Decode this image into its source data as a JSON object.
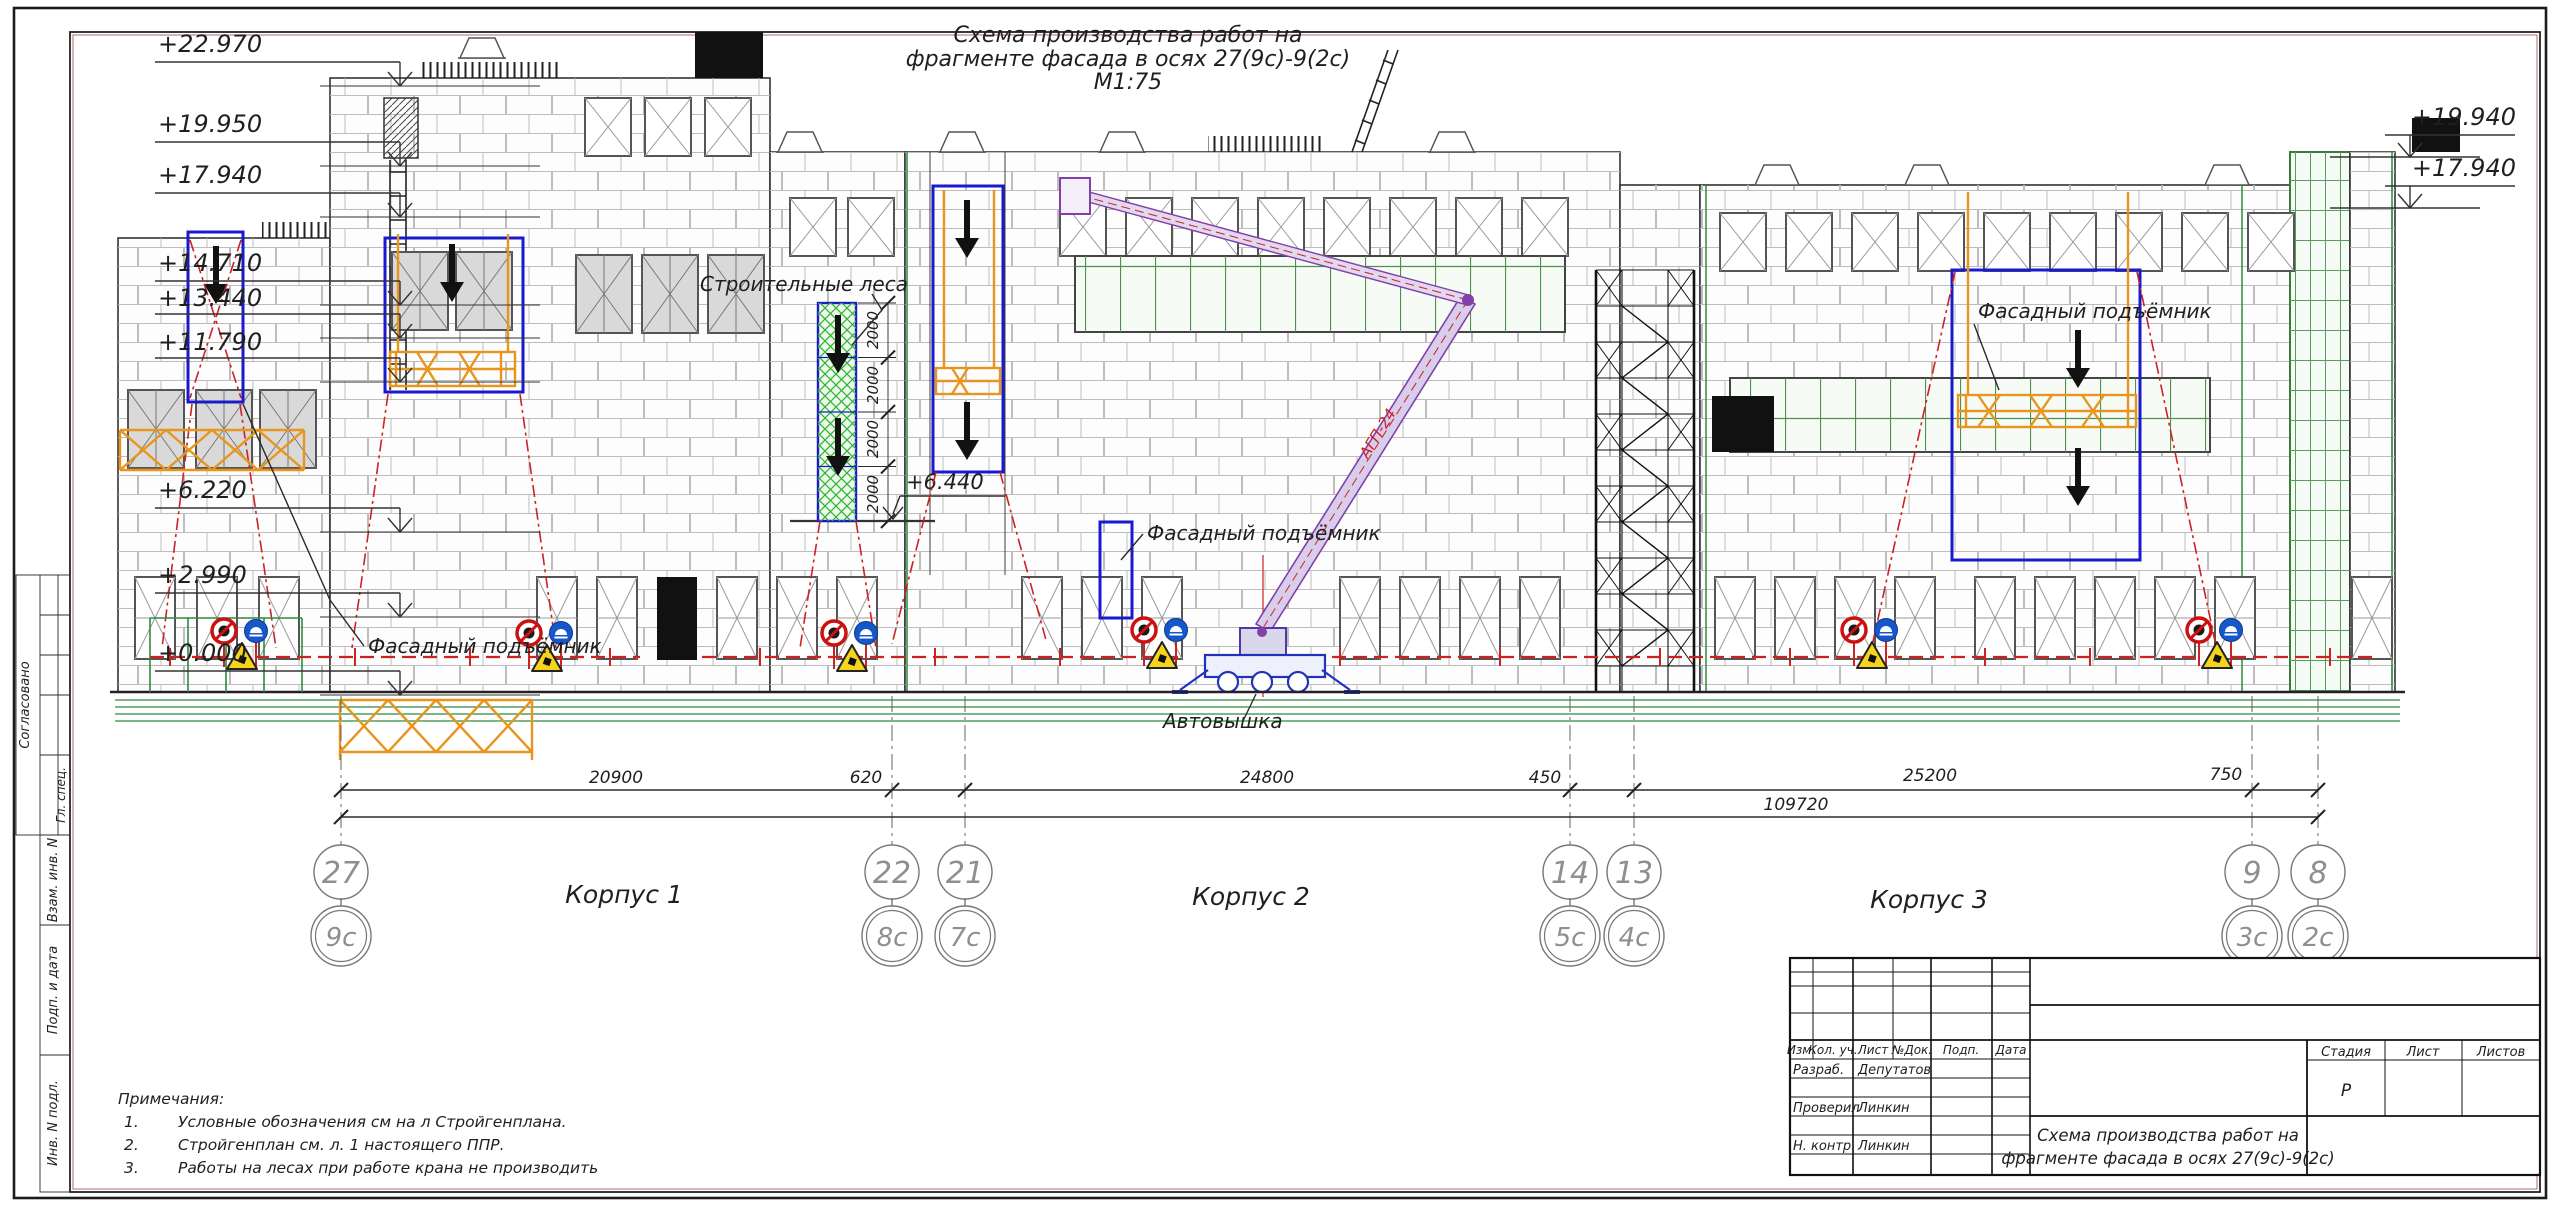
{
  "drawing_title": {
    "line1": "Схема производства работ на",
    "line2": "фрагменте фасада в осях 27(9с)-9(2с)",
    "scale": "М1:75"
  },
  "elevations_left": [
    "+22.970",
    "+19.950",
    "+17.940",
    "+14.710",
    "+13.440",
    "+11.790",
    "+6.220",
    "+2.990",
    "+0.000"
  ],
  "elevations_right": [
    "+19.940",
    "+17.940"
  ],
  "elevation_mid": "+6.440",
  "labels": {
    "scaffold": "Строительные леса",
    "facade_hoist": "Фасадный подъёмник",
    "boom_truck": "Автовышка",
    "boom_model": "АГП-24"
  },
  "scaffold_dims": [
    "2000",
    "2000",
    "2000",
    "2000"
  ],
  "dimensions": {
    "segments": [
      "20900",
      "620",
      "24800",
      "450",
      "25200",
      "750"
    ],
    "total": "109720"
  },
  "axes": {
    "top": [
      "27",
      "22",
      "21",
      "14",
      "13",
      "9",
      "8"
    ],
    "bottom": [
      "9с",
      "8с",
      "7с",
      "5с",
      "4с",
      "3с",
      "2с"
    ]
  },
  "buildings": [
    "Корпус 1",
    "Корпус 2",
    "Корпус 3"
  ],
  "notes": {
    "title": "Примечания:",
    "items": [
      {
        "num": "1.",
        "text": "Условные обозначения см на л Стройгенплана."
      },
      {
        "num": "2.",
        "text": "Стройгенплан см. л. 1 настоящего ППР."
      },
      {
        "num": "3.",
        "text": "Работы на лесах при работе крана не производить"
      }
    ]
  },
  "side_bar": {
    "approved": "Согласовано",
    "chief_spec": "Гл. спец.",
    "replace_inv": "Взам. инв. N",
    "sign_date": "Подп. и дата",
    "inv_orig": "Инв. N подл."
  },
  "title_block": {
    "headers": [
      "Изм.",
      "Кол. уч.",
      "Лист",
      "№Док.",
      "Подп.",
      "Дата"
    ],
    "rows": [
      {
        "role": "Разраб.",
        "name": "Депутатов"
      },
      {
        "role": "Проверил",
        "name": "Линкин"
      },
      {
        "role": "Н. контр.",
        "name": "Линкин"
      }
    ],
    "stage_label": "Стадия",
    "sheet_label": "Лист",
    "sheets_label": "Листов",
    "stage_value": "Р",
    "doc_title_line1": "Схема производства работ на",
    "doc_title_line2": "фрагменте фасада в осях 27(9с)-9(2с)"
  }
}
